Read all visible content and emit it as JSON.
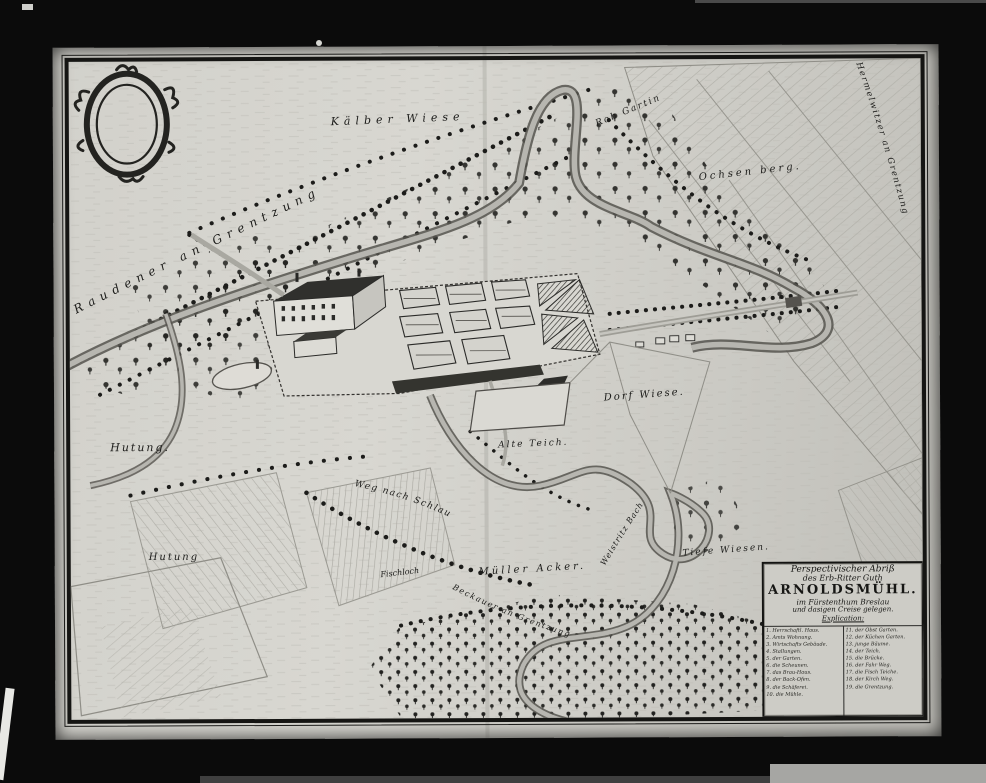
{
  "colors": {
    "photo_background": "#0b0b0b",
    "sheet": "#d1d0ca",
    "ink": "#1b1b19",
    "frame": "#151513",
    "water_edge": "#55534e",
    "water_fill": "#b7b6b0"
  },
  "labels": [
    {
      "id": "raudener-boundary",
      "text": "Raudener an Grentzung"
    },
    {
      "id": "kaelber-wiese",
      "text": "Kälber Wiese"
    },
    {
      "id": "rob-gartin",
      "text": "Rob Gartin"
    },
    {
      "id": "ochsen-berg",
      "text": "Ochsen berg."
    },
    {
      "id": "hermelwitzer-boundary",
      "text": "Hermelwitzer an Grentzung"
    },
    {
      "id": "hutung-west",
      "text": "Hutung."
    },
    {
      "id": "dorf-wiese",
      "text": "Dorf Wiese."
    },
    {
      "id": "alte-teich",
      "text": "Alte Teich."
    },
    {
      "id": "weg-nach-schlau",
      "text": "Weg nach Schlau"
    },
    {
      "id": "hutung-south",
      "text": "Hutung"
    },
    {
      "id": "fischloch",
      "text": "Fischloch"
    },
    {
      "id": "mueller-acker",
      "text": "Müller Acker."
    },
    {
      "id": "tiefe-wiesen",
      "text": "Tiefe Wiesen."
    },
    {
      "id": "bach",
      "text": "Weistritz Bach"
    },
    {
      "id": "south-boundary",
      "text": "Beckauer an Grentzung"
    }
  ],
  "title_box": {
    "lines": [
      "Perspectivischer Abriß",
      "des Erb-Ritter Guth",
      "ARNOLDSMÜHL.",
      "im Fürstenthum Breslau",
      "und dasigen Creise gelegen.",
      "Explication:"
    ],
    "legend_left": [
      "1. Herrschaftl. Haus.",
      "2. Amts Wohnung.",
      "3. Wirtschafts Gebäude.",
      "4. Stallungen.",
      "5. der Garten.",
      "6. die Scheunen.",
      "7. das Brau-Haus.",
      "8. der Back-Ofen.",
      "9. die Schäferei.",
      "10. die Mühle."
    ],
    "legend_right": [
      "11. der Obst Garten.",
      "12. der Küchen Garten.",
      "13. junge Bäume.",
      "14. der Teich.",
      "15. die Brücke.",
      "16. der Fahr Weg.",
      "17. die Fisch Teiche.",
      "18. der Kirch Weg.",
      "19. die Grentzung."
    ]
  }
}
